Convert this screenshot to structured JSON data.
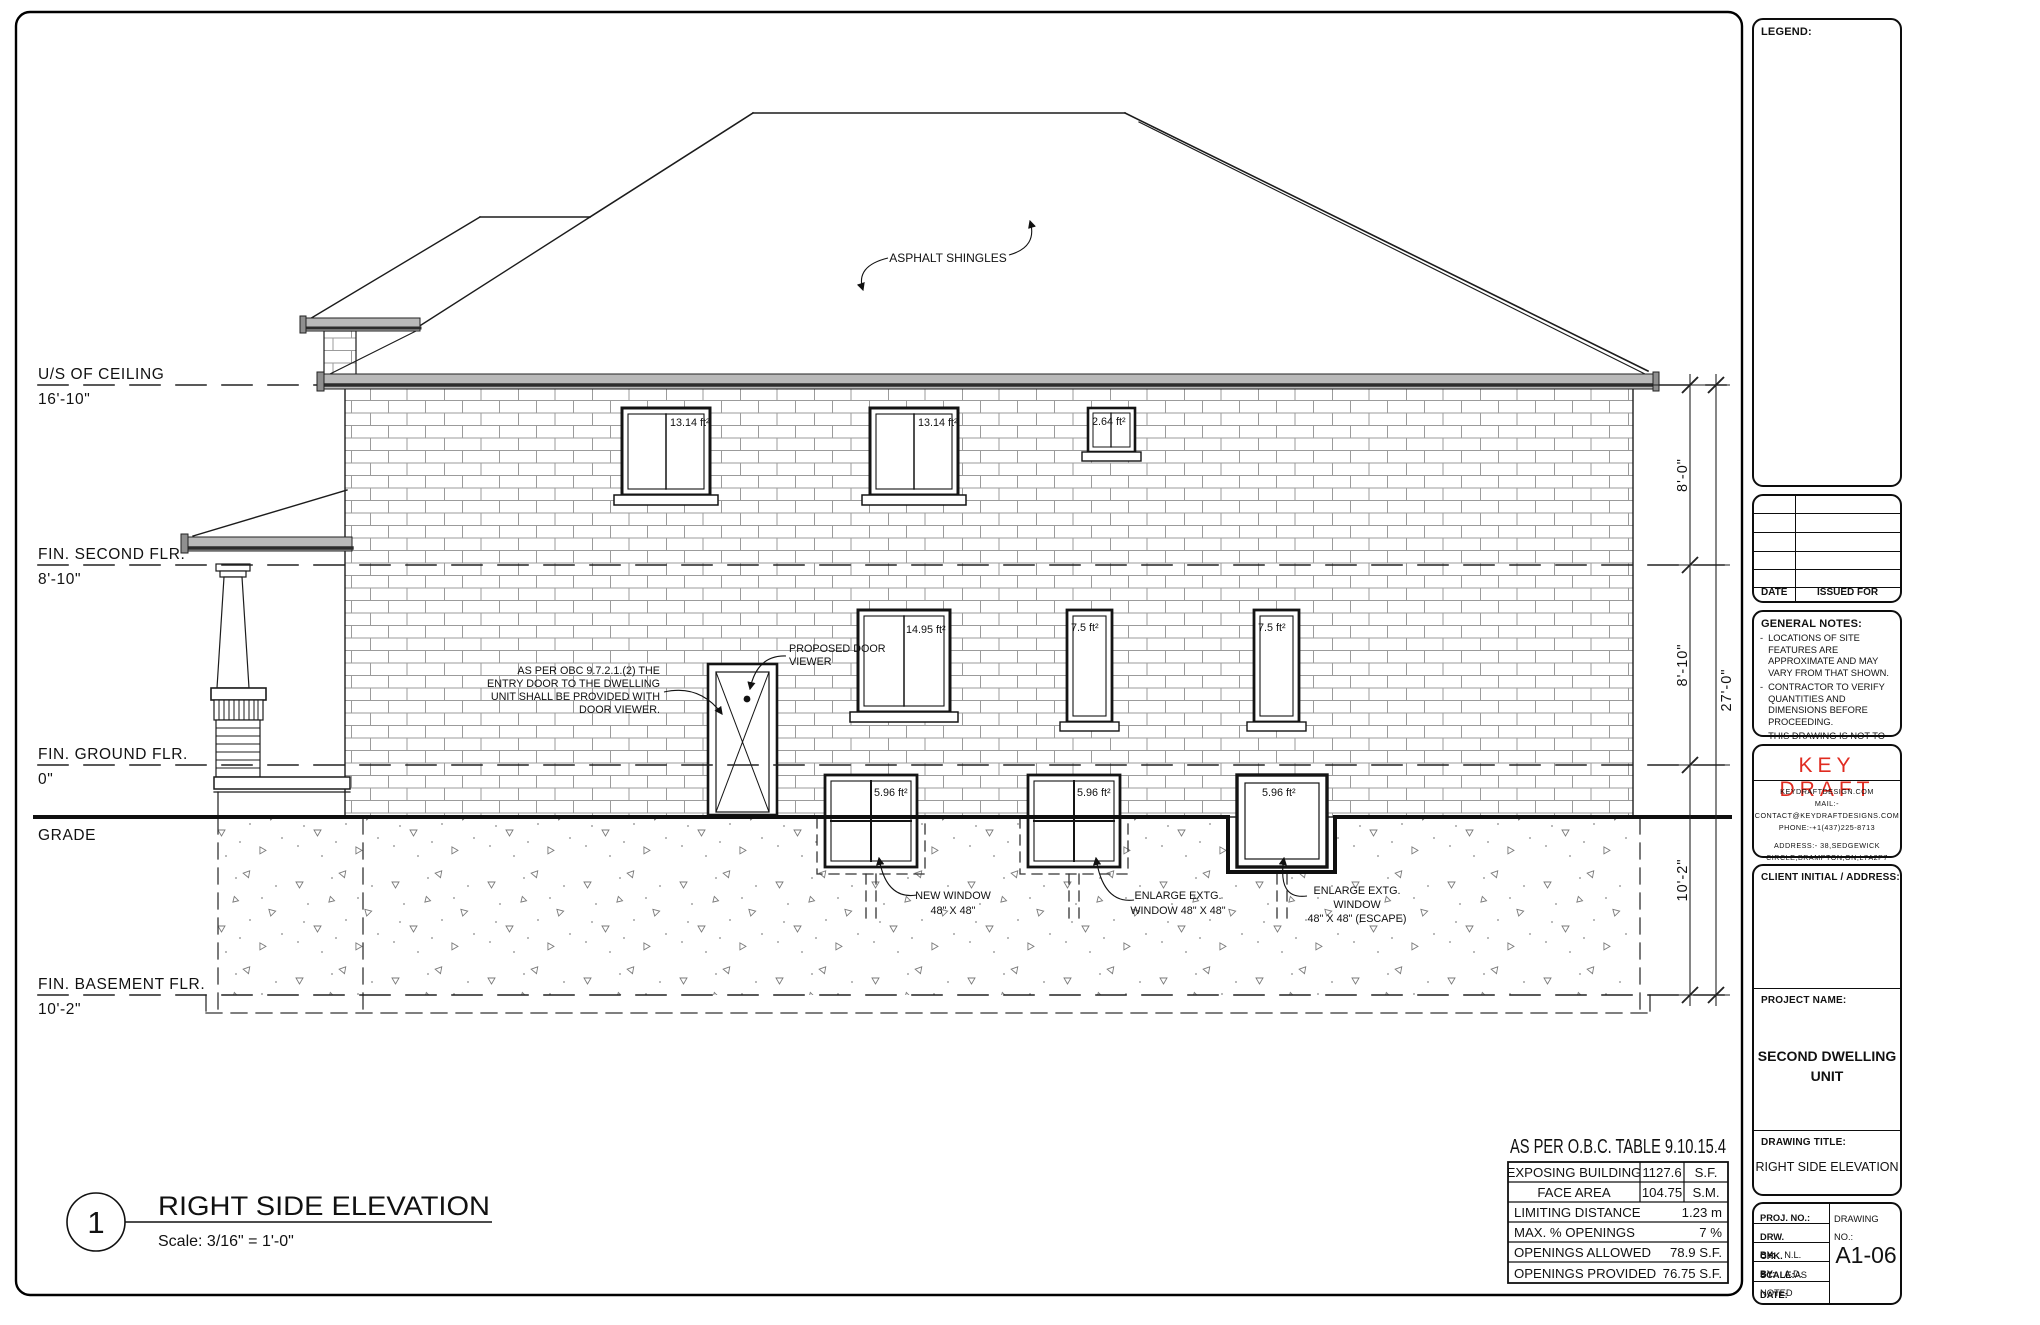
{
  "colors": {
    "brand_red": "#e02b20",
    "line_dark": "#1c1c1c"
  },
  "panel": {
    "legend_title": "LEGEND:",
    "issued_for": {
      "date": "DATE",
      "issued": "ISSUED FOR"
    },
    "general_notes": {
      "title": "GENERAL NOTES:",
      "items": [
        "LOCATIONS OF SITE FEATURES ARE APPROXIMATE AND MAY VARY FROM THAT SHOWN.",
        "CONTRACTOR TO VERIFY QUANTITIES AND DIMENSIONS BEFORE PROCEEDING.",
        "THIS DRAWING IS NOT TO BE SCALED"
      ]
    },
    "firm": {
      "name": "KEY DRAFT",
      "site": "KEYDRAFTDESIGN.COM",
      "mail": "MAIL:-CONTACT@KEYDRAFTDESIGNS.COM",
      "phone": "PHONE:-+1(437)225-8713",
      "address_line1": "ADDRESS:- 38,SEDGEWICK",
      "address_line2": "CIRCLE,BRAMPTON,ON,L7A2P7"
    },
    "client_label": "CLIENT INITIAL / ADDRESS:",
    "project_label": "PROJECT NAME:",
    "project_name_line1": "SECOND DWELLING",
    "project_name_line2": "UNIT",
    "drawing_title_label": "DRAWING TITLE:",
    "drawing_title": "RIGHT SIDE ELEVATION",
    "titleblock": {
      "proj_no_label": "PROJ. NO.:",
      "drawing_no_label": "DRAWING NO.:",
      "drw_by_label": "DRW. BY:",
      "drw_by_value": "N.L.",
      "chk_by_label": "CHK. BY:",
      "chk_by_value": "A.D.",
      "scale_label": "SCALE:",
      "scale_value": "AS NOTED",
      "date_label": "DATE:",
      "drawing_no": "A1-06"
    }
  },
  "obc": {
    "title": "AS PER O.B.C. TABLE 9.10.15.4",
    "exposing_line1": "EXPOSING BUILDING",
    "exposing_line2": "FACE AREA",
    "exposing_sf": "1127.6",
    "exposing_sf_unit": "S.F.",
    "exposing_sm": "104.75",
    "exposing_sm_unit": "S.M.",
    "limiting_label": "LIMITING DISTANCE",
    "limiting_value": "1.23 m",
    "max_label": "MAX. % OPENINGS",
    "max_value": "7 %",
    "allowed_label": "OPENINGS ALLOWED",
    "allowed_value": "78.9 S.F.",
    "provided_label": "OPENINGS PROVIDED",
    "provided_value": "76.75 S.F."
  },
  "viewtitle": {
    "number": "1",
    "title": "RIGHT SIDE ELEVATION",
    "scale": "Scale: 3/16\" = 1'-0\""
  },
  "levels": {
    "ceiling_label": "U/S OF CEILING",
    "ceiling_value": "16'-10\"",
    "second_label": "FIN. SECOND FLR.",
    "second_value": "8'-10\"",
    "ground_label": "FIN. GROUND FLR.",
    "ground_value": "0\"",
    "grade_label": "GRADE",
    "basement_label": "FIN. BASEMENT FLR.",
    "basement_value": "10'-2\""
  },
  "dimensions": {
    "upper": "8'-0\"",
    "middle": "8'-10\"",
    "lower": "10'-2\"",
    "overall": "27'-0\""
  },
  "windows": {
    "second_a": "13.14 ft²",
    "second_b": "13.14 ft²",
    "second_small": "2.64 ft²",
    "ground_big": "14.95 ft²",
    "ground_a": "7.5 ft²",
    "ground_b": "7.5 ft²",
    "basement_a": "5.96 ft²",
    "basement_b": "5.96 ft²",
    "basement_c": "5.96 ft²"
  },
  "notes": {
    "shingles": "ASPHALT SHINGLES",
    "door_note_line1": "AS PER OBC 9.7.2.1.(2) THE",
    "door_note_line2": "ENTRY DOOR TO THE DWELLING",
    "door_note_line3": "UNIT SHALL BE PROVIDED WITH",
    "door_note_line4": "DOOR VIEWER.",
    "viewer_line1": "PROPOSED DOOR",
    "viewer_line2": "VIEWER",
    "new_window_line1": "NEW WINDOW",
    "new_window_line2": "48\" X 48\"",
    "enlarge1_line1": "ENLARGE EXTG.",
    "enlarge1_line2": "WINDOW 48\" X 48\"",
    "enlarge2_line1": "ENLARGE EXTG.",
    "enlarge2_line2": "WINDOW",
    "enlarge2_line3": "48\" X 48\" (ESCAPE)"
  }
}
